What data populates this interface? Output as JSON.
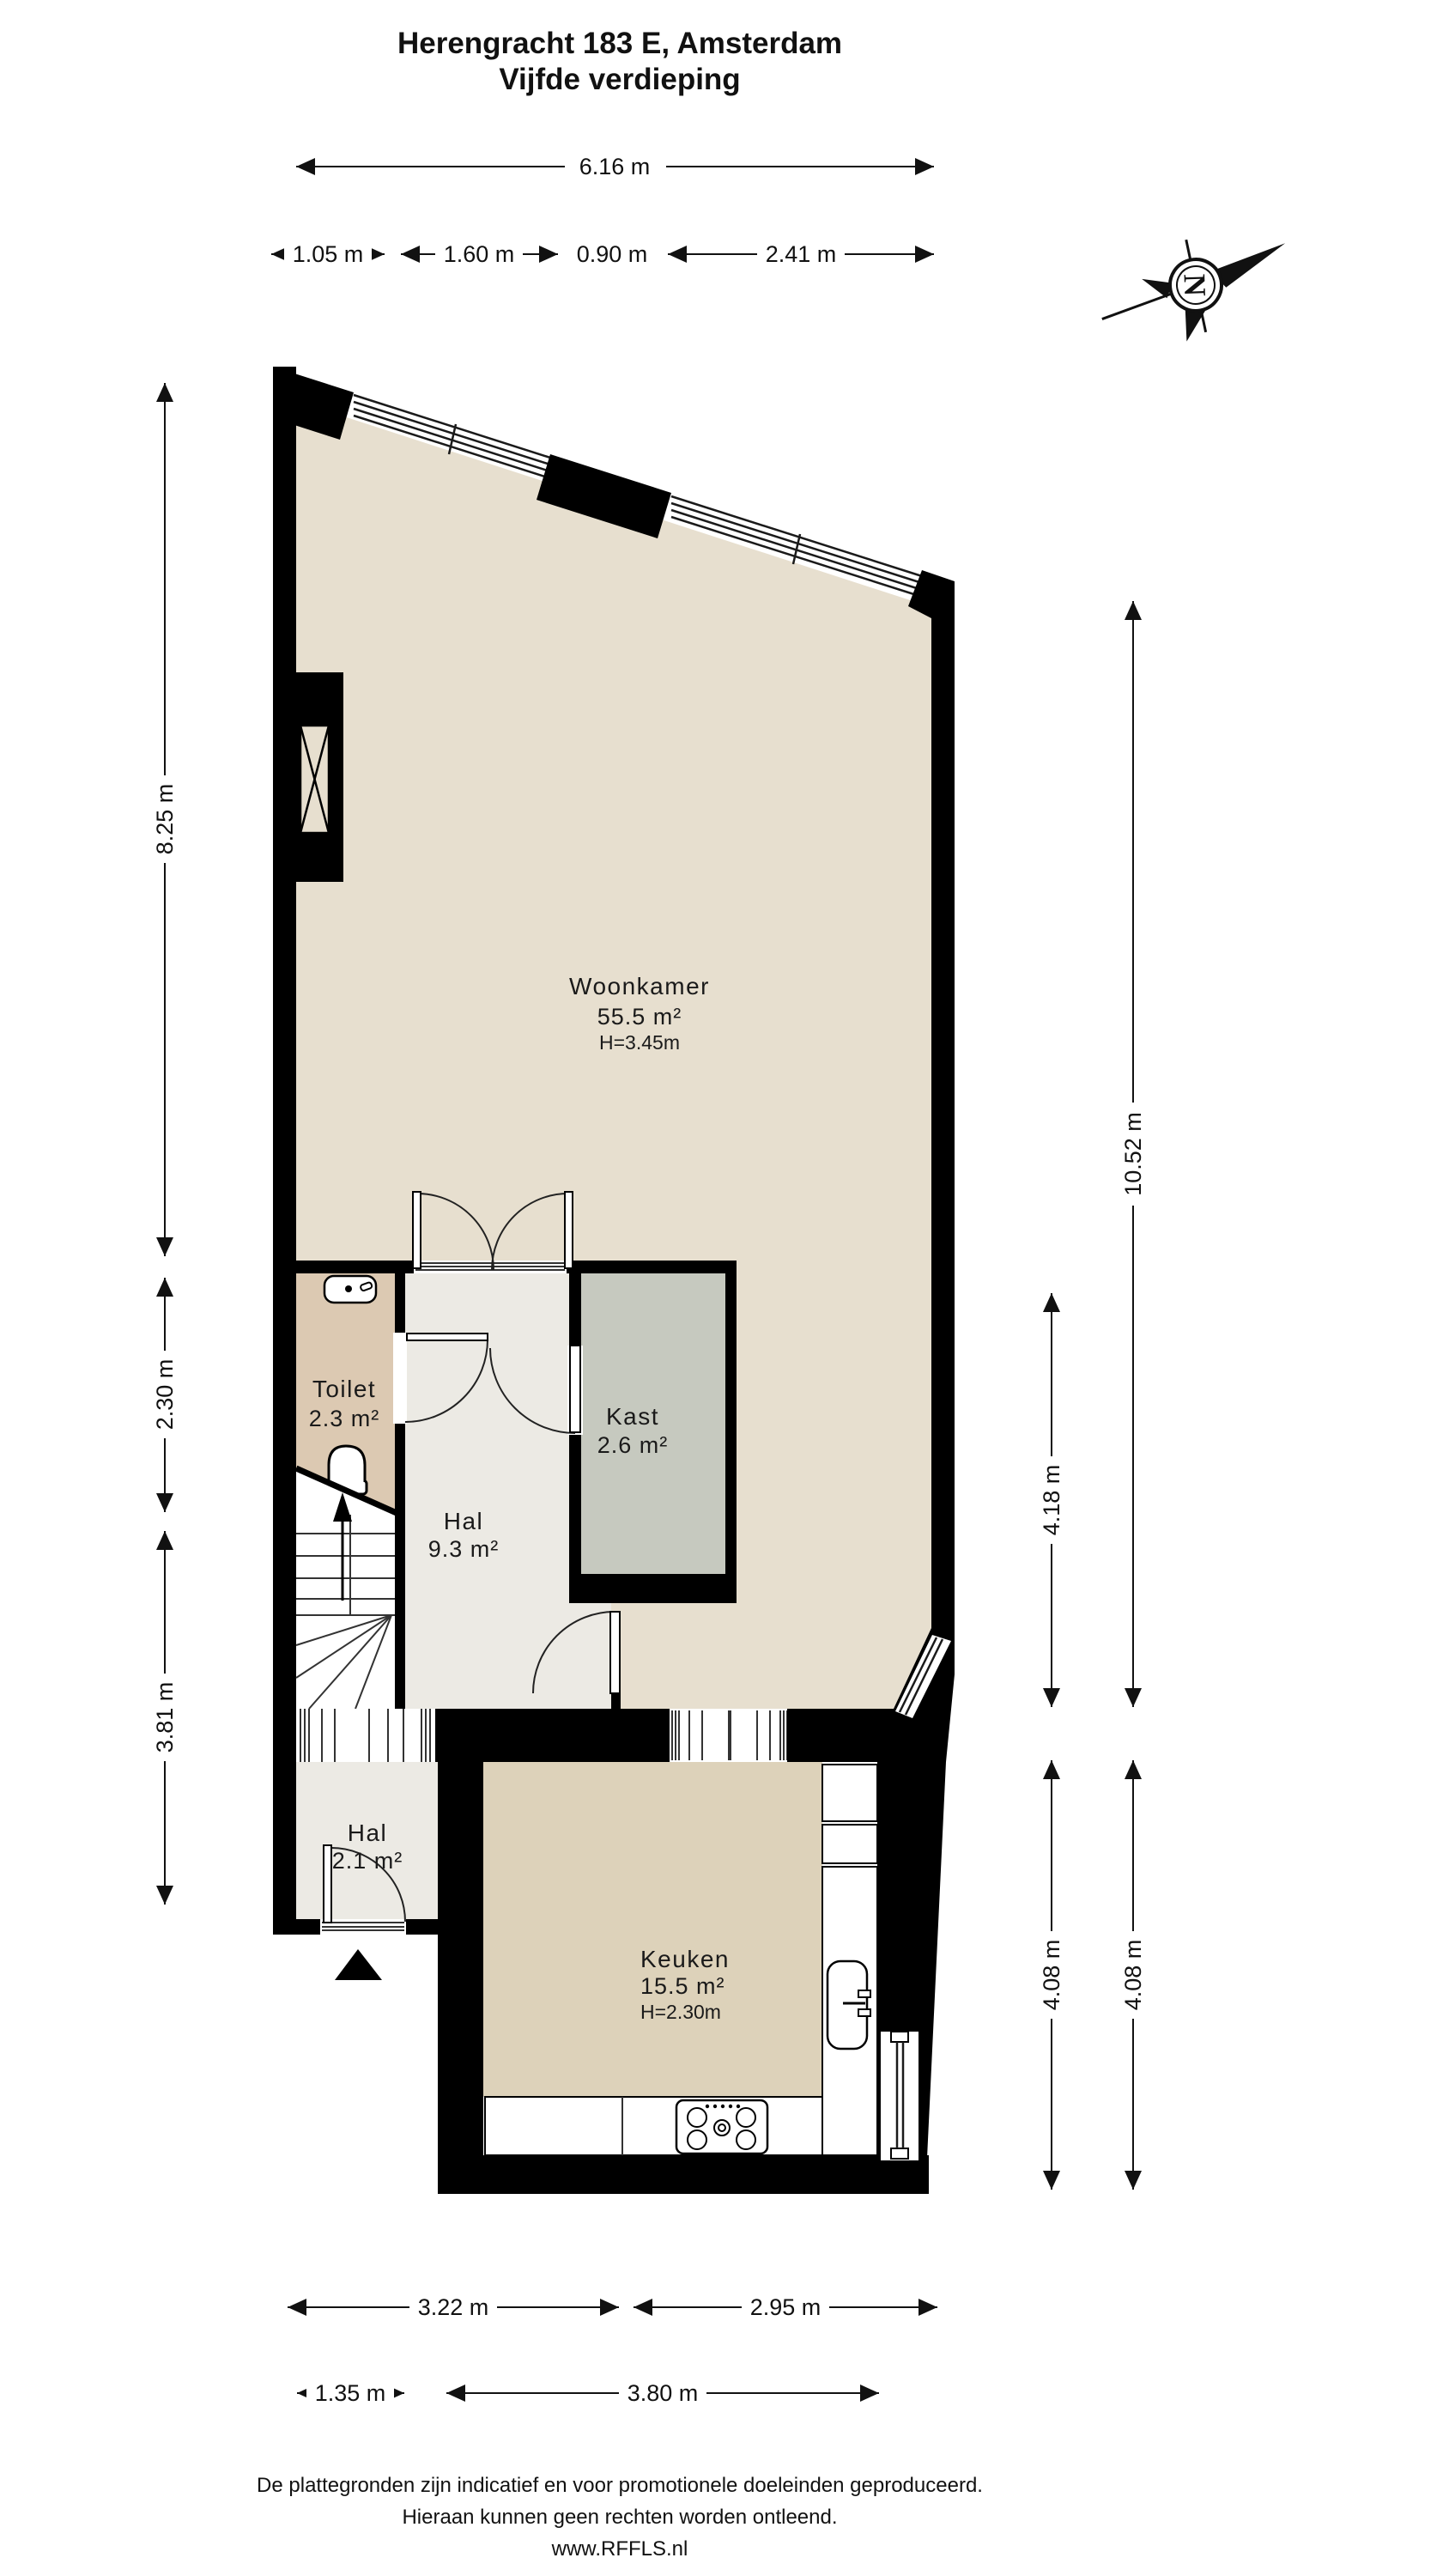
{
  "title": {
    "line1": "Herengracht 183 E, Amsterdam",
    "line2": "Vijfde verdieping"
  },
  "compass": {
    "label": "N"
  },
  "dims": {
    "top_total": "6.16 m",
    "top_1": "1.05 m",
    "top_2": "1.60 m",
    "top_3": "0.90 m",
    "top_4": "2.41 m",
    "left_1": "8.25 m",
    "left_2": "2.30 m",
    "left_3": "3.81 m",
    "right_1": "10.52 m",
    "right_2": "4.18 m",
    "right_3": "4.08 m",
    "right_4": "4.08 m",
    "bottom_1": "3.22 m",
    "bottom_2": "2.95 m",
    "bottom_3": "1.35 m",
    "bottom_4": "3.80 m"
  },
  "rooms": {
    "woonkamer": {
      "name": "Woonkamer",
      "area": "55.5 m²",
      "ceiling": "H=3.45m"
    },
    "toilet": {
      "name": "Toilet",
      "area": "2.3 m²"
    },
    "hal": {
      "name": "Hal",
      "area": "9.3 m²"
    },
    "kast": {
      "name": "Kast",
      "area": "2.6 m²"
    },
    "hal2": {
      "name": "Hal",
      "area": "2.1 m²"
    },
    "keuken": {
      "name": "Keuken",
      "area": "15.5 m²",
      "ceiling": "H=2.30m"
    }
  },
  "footer": {
    "line1": "De plattegronden zijn indicatief en voor promotionele doeleinden geproduceerd.",
    "line2": "Hieraan kunnen geen rechten worden ontleend.",
    "line3": "www.RFFLS.nl"
  },
  "colors": {
    "wall": "#000000",
    "background": "#ffffff",
    "woonkamer_floor": "#e7dfcf",
    "keuken_floor": "#ddd2ba",
    "toilet_floor": "#dcc9b2",
    "hal_floor": "#eceae4",
    "kast_floor": "#c6c9bf"
  }
}
